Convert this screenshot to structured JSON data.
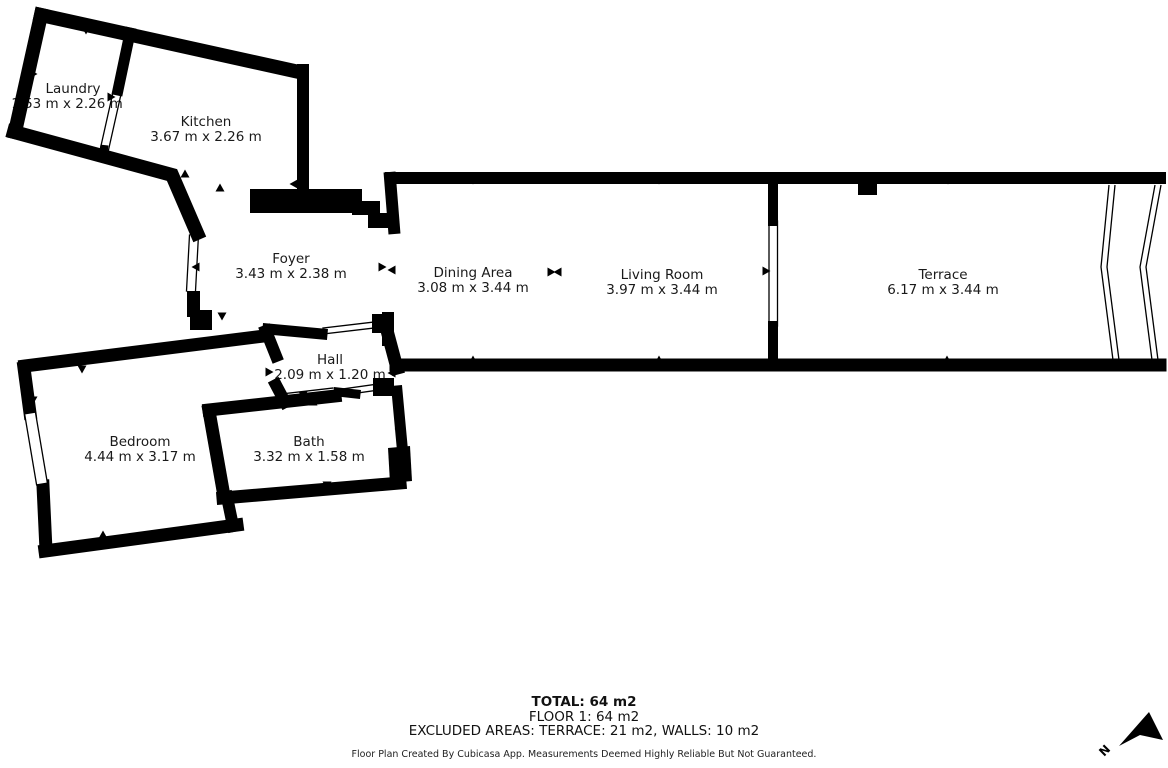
{
  "colors": {
    "wall": "#000000",
    "background": "#ffffff",
    "text": "#1a1a1a"
  },
  "rooms": [
    {
      "id": "laundry",
      "name": "Laundry",
      "dims": "1.53 m x 2.26 m"
    },
    {
      "id": "kitchen",
      "name": "Kitchen",
      "dims": "3.67 m x 2.26 m"
    },
    {
      "id": "foyer",
      "name": "Foyer",
      "dims": "3.43 m x 2.38 m"
    },
    {
      "id": "dining",
      "name": "Dining Area",
      "dims": "3.08 m x 3.44 m"
    },
    {
      "id": "living",
      "name": "Living Room",
      "dims": "3.97 m x 3.44 m"
    },
    {
      "id": "terrace",
      "name": "Terrace",
      "dims": "6.17 m x 3.44 m"
    },
    {
      "id": "hall",
      "name": "Hall",
      "dims": "2.09 m x 1.20 m"
    },
    {
      "id": "bedroom",
      "name": "Bedroom",
      "dims": "4.44 m x 3.17 m"
    },
    {
      "id": "bath",
      "name": "Bath",
      "dims": "3.32 m x 1.58 m"
    }
  ],
  "summary": {
    "total": "TOTAL: 64 m2",
    "floor": "FLOOR 1: 64 m2",
    "excluded": "EXCLUDED AREAS: TERRACE: 21 m2, WALLS: 10 m2"
  },
  "credit": "Floor Plan Created By Cubicasa App. Measurements Deemed Highly Reliable But Not Guaranteed.",
  "compass": {
    "label": "N"
  }
}
